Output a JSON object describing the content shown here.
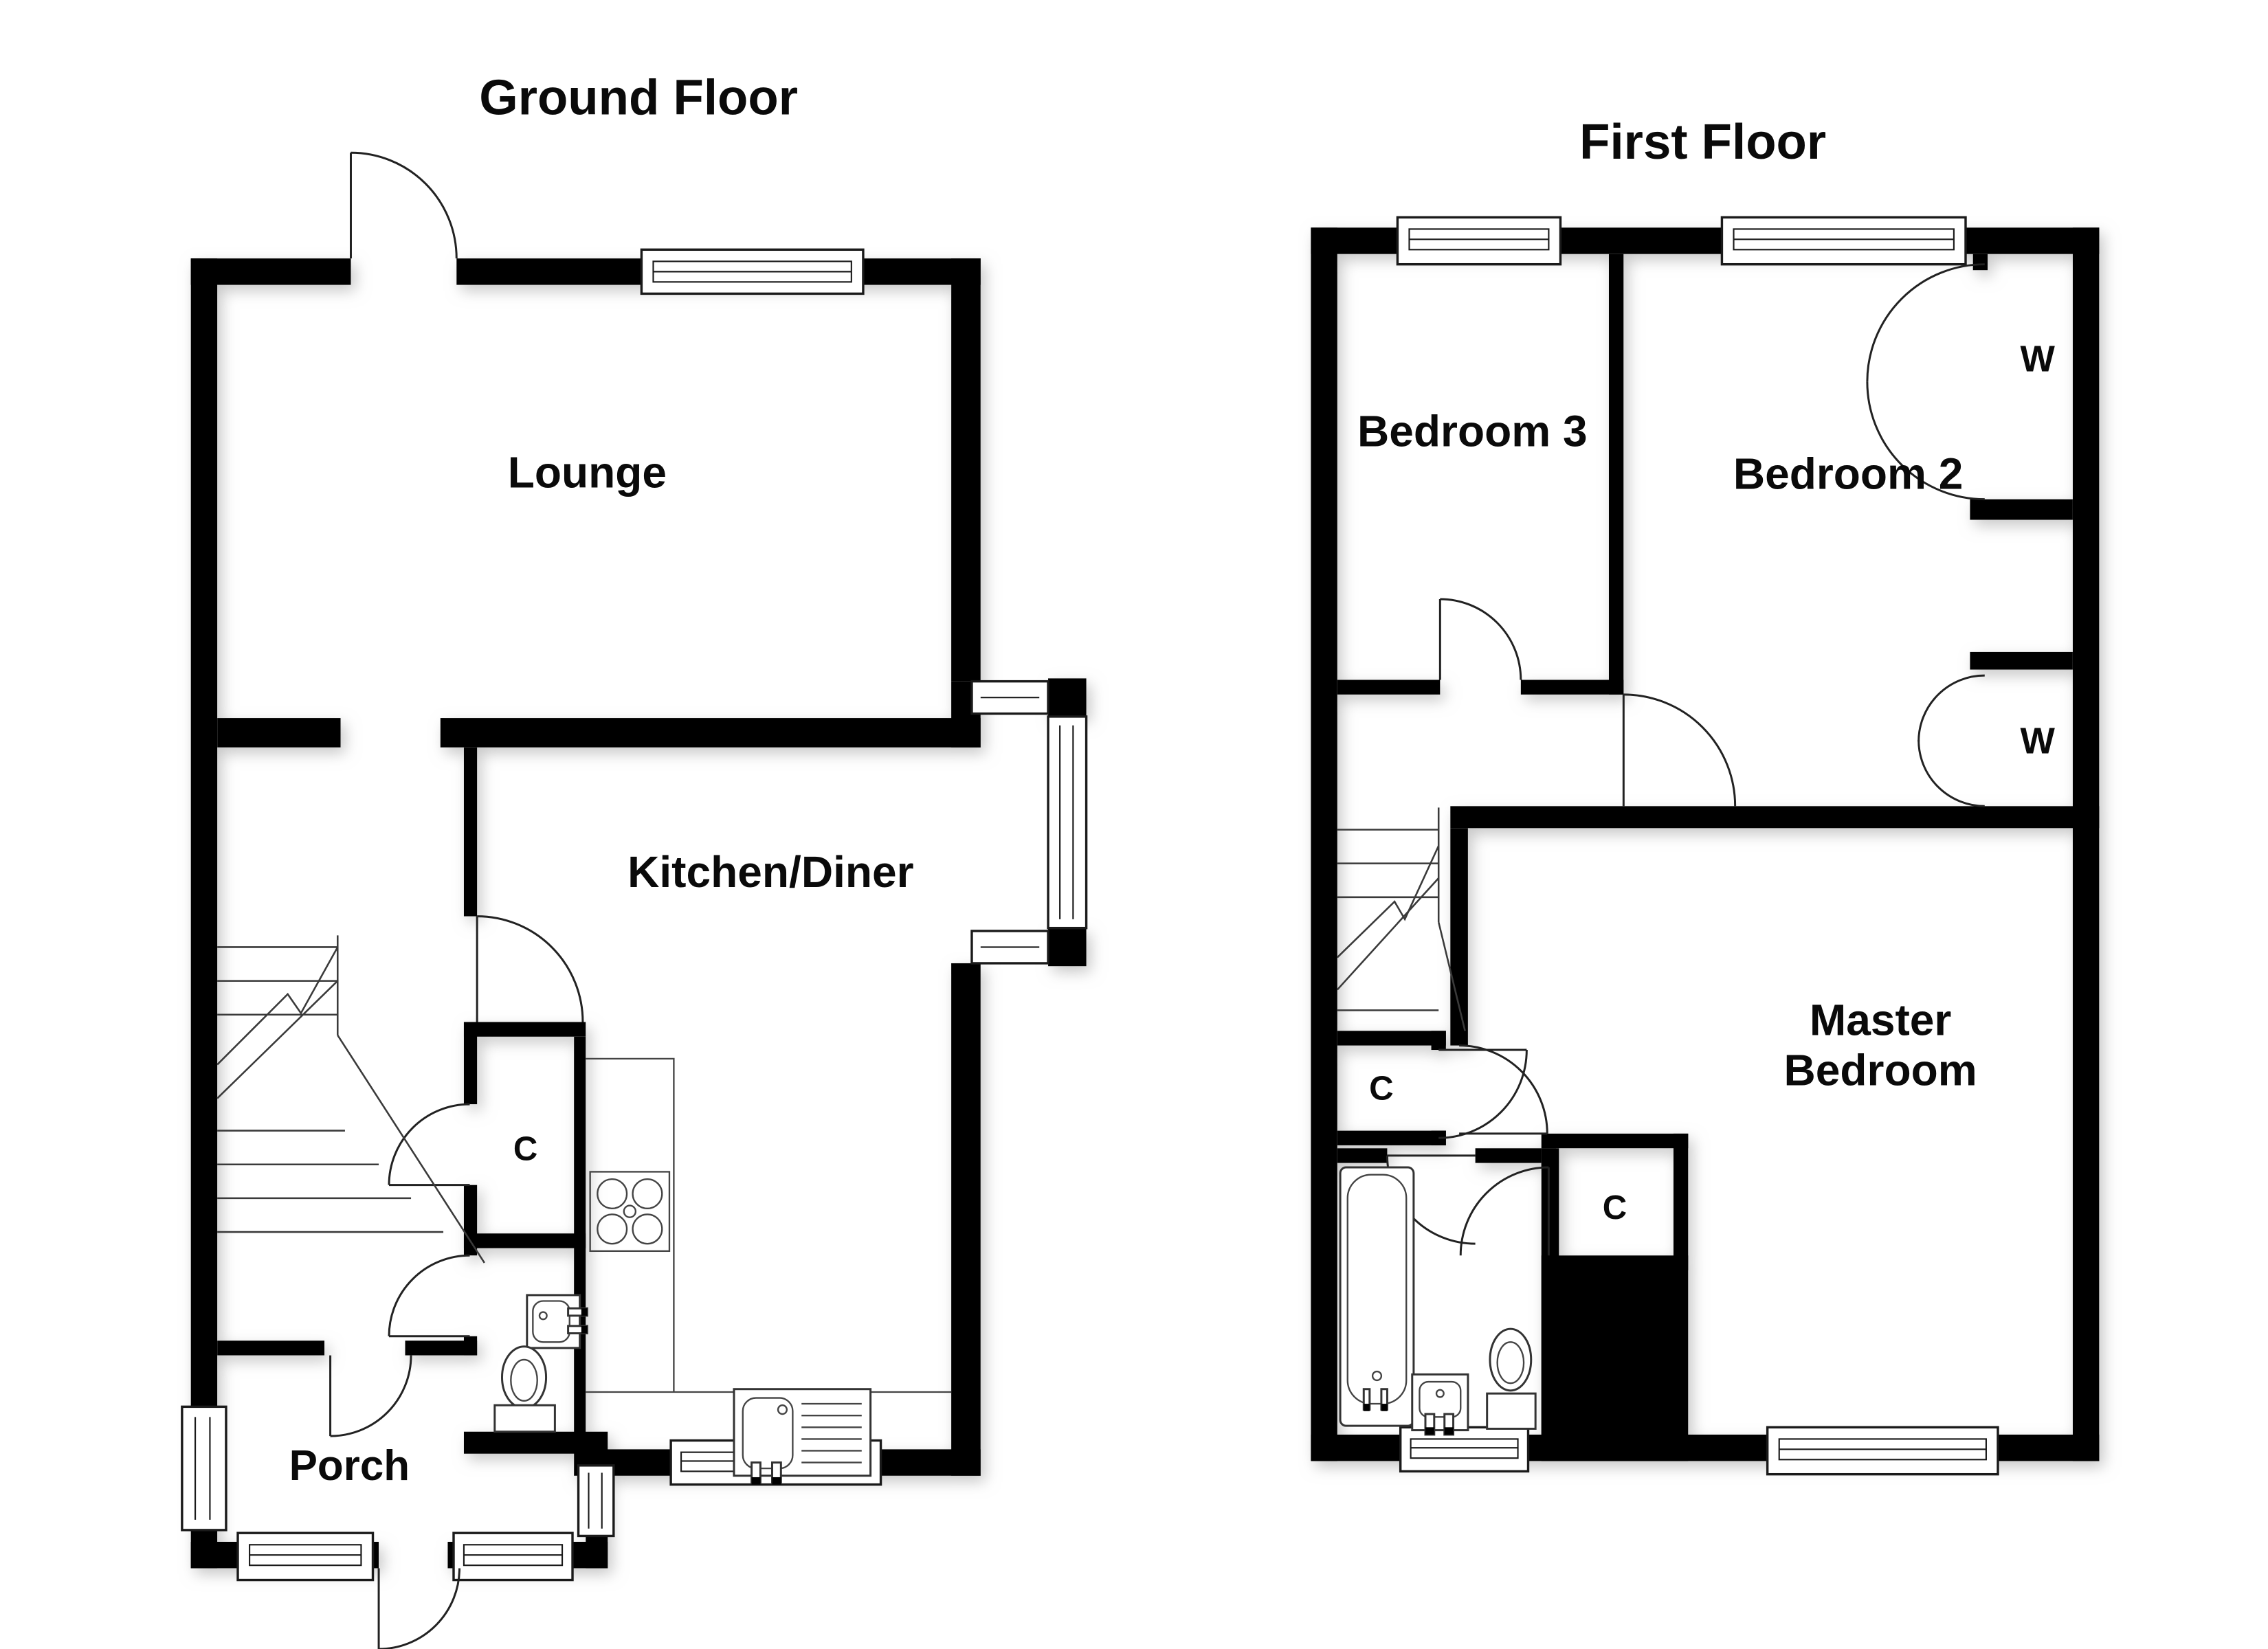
{
  "page": {
    "background_color": "#ffffff",
    "wall_color": "#000000",
    "shadow_color": "#9a9a9a"
  },
  "ground_floor": {
    "title": "Ground Floor",
    "lounge_label": "Lounge",
    "kitchen_label": "Kitchen/Diner",
    "porch_label": "Porch",
    "closet_label": "C"
  },
  "first_floor": {
    "title": "First Floor",
    "bedroom3_label": "Bedroom 3",
    "bedroom2_label": "Bedroom 2",
    "master_label_line1": "Master",
    "master_label_line2": "Bedroom",
    "wardrobe_top_label": "W",
    "wardrobe_bottom_label": "W",
    "landing_closet_label": "C",
    "master_closet_label": "C"
  }
}
